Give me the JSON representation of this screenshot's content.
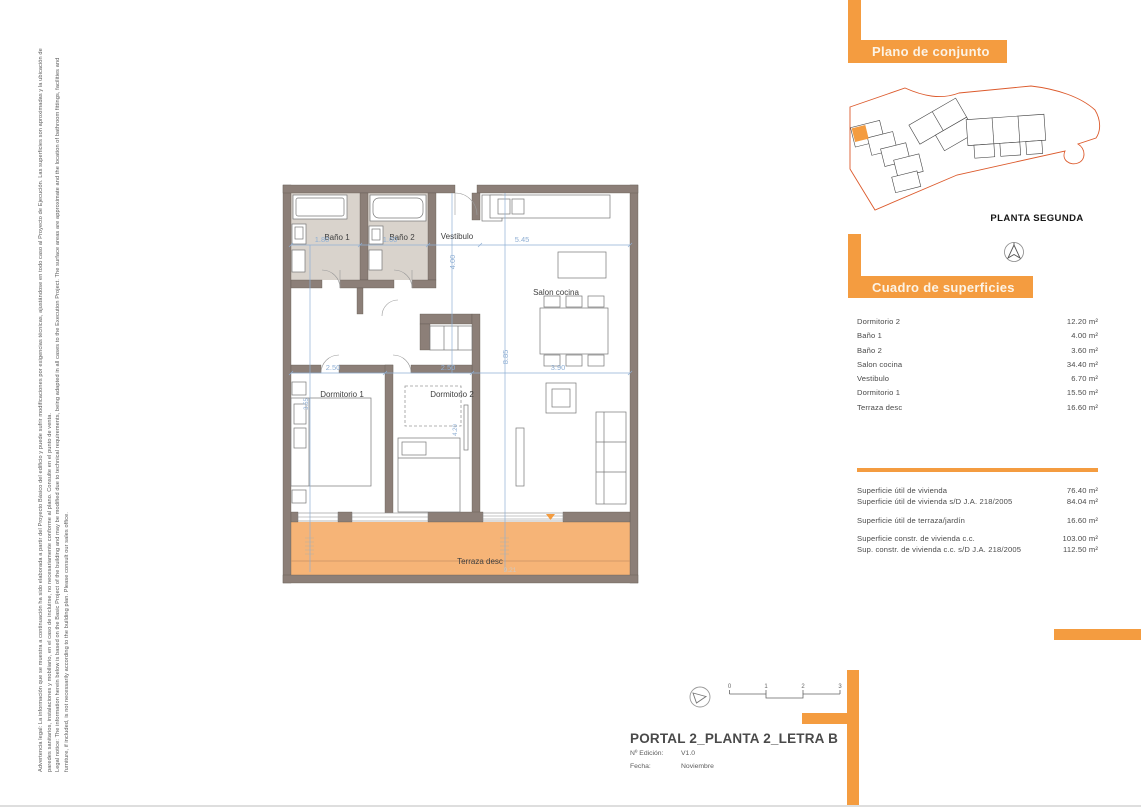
{
  "colors": {
    "accent": "#F49C40",
    "terrace_fill": "#F6B477",
    "wall": "#8C7F78",
    "bath_floor": "#D9D3CC",
    "dimension_blue": "#8FAFD4",
    "site_boundary": "#DC5A2C"
  },
  "legal": {
    "es": "Advertencia legal: La información que se muestra a continuación ha sido elaborada a partir del Proyecto Básico del edificio y puede sufrir modificaciones por exigencias técnicas, ajustándose en todo caso al Proyecto de Ejecución. Las superficies son aproximadas y la ubicación de paredes sanitarios, instalaciones y mobiliario, en el caso de incluirse, no necesariamente conforme al plano. Consulte en el punto de venta.",
    "en": "Legal notice: The information herein below is based on the Basic Project of the building and may be modified due to technical requirements, being adapted in all cases to the Execution Project. The surface areas are approximate and the location of bathroom fittings, facilities and furniture, if included, is not necessarily according to the building plan. Please consult our sales office."
  },
  "floor_plan": {
    "rooms": {
      "bano1": "Baño 1",
      "bano2": "Baño 2",
      "vestibulo": "Vestibulo",
      "salon": "Salon cocina",
      "dormitorio1": "Dormitorio 1",
      "dormitorio2": "Dormitorio 2",
      "terraza": "Terraza desc"
    },
    "dimensions": {
      "bano1_w": "1.80",
      "bano2_w": "1.60",
      "vestibulo_h": "4.00",
      "salon_w": "5.45",
      "salon_h": "8.85",
      "salon_w2": "3.90",
      "dorm1_w": "2.50",
      "dorm2_w": "2.50",
      "dorm1_h": "3.55",
      "dorm2_h": "4.20",
      "terraza_w": "9.21"
    }
  },
  "site_plan": {
    "header": "Plano de conjunto",
    "floor_label": "PLANTA SEGUNDA"
  },
  "areas": {
    "header": "Cuadro de superficies",
    "rows": [
      {
        "label": "Dormitorio 2",
        "value": "12.20 m²"
      },
      {
        "label": "Baño 1",
        "value": "4.00 m²"
      },
      {
        "label": "Baño 2",
        "value": "3.60 m²"
      },
      {
        "label": "Salon cocina",
        "value": "34.40 m²"
      },
      {
        "label": "Vestibulo",
        "value": "6.70 m²"
      },
      {
        "label": "Dormitorio 1",
        "value": "15.50 m²"
      },
      {
        "label": "Terraza desc",
        "value": "16.60 m²"
      }
    ],
    "summary": [
      {
        "label": "Superficie útil de vivienda",
        "value": "76.40 m²"
      },
      {
        "label": "Superficie útil de vivienda s/D J.A. 218/2005",
        "value": "84.04 m²"
      },
      {
        "label": "Superficie útil de terraza/jardín",
        "value": "16.60 m²"
      },
      {
        "label": "Superficie constr. de vivienda c.c.",
        "value": "103.00 m²"
      },
      {
        "label": "Sup. constr. de vivienda c.c. s/D J.A. 218/2005",
        "value": "112.50 m²"
      }
    ]
  },
  "title_block": {
    "title": "PORTAL 2_PLANTA 2_LETRA B",
    "edition_label": "Nº Edición:",
    "edition_value": "V1.0",
    "date_label": "Fecha:",
    "date_value": "Noviembre",
    "scale_ticks": [
      "0",
      "1",
      "2",
      "3"
    ]
  }
}
